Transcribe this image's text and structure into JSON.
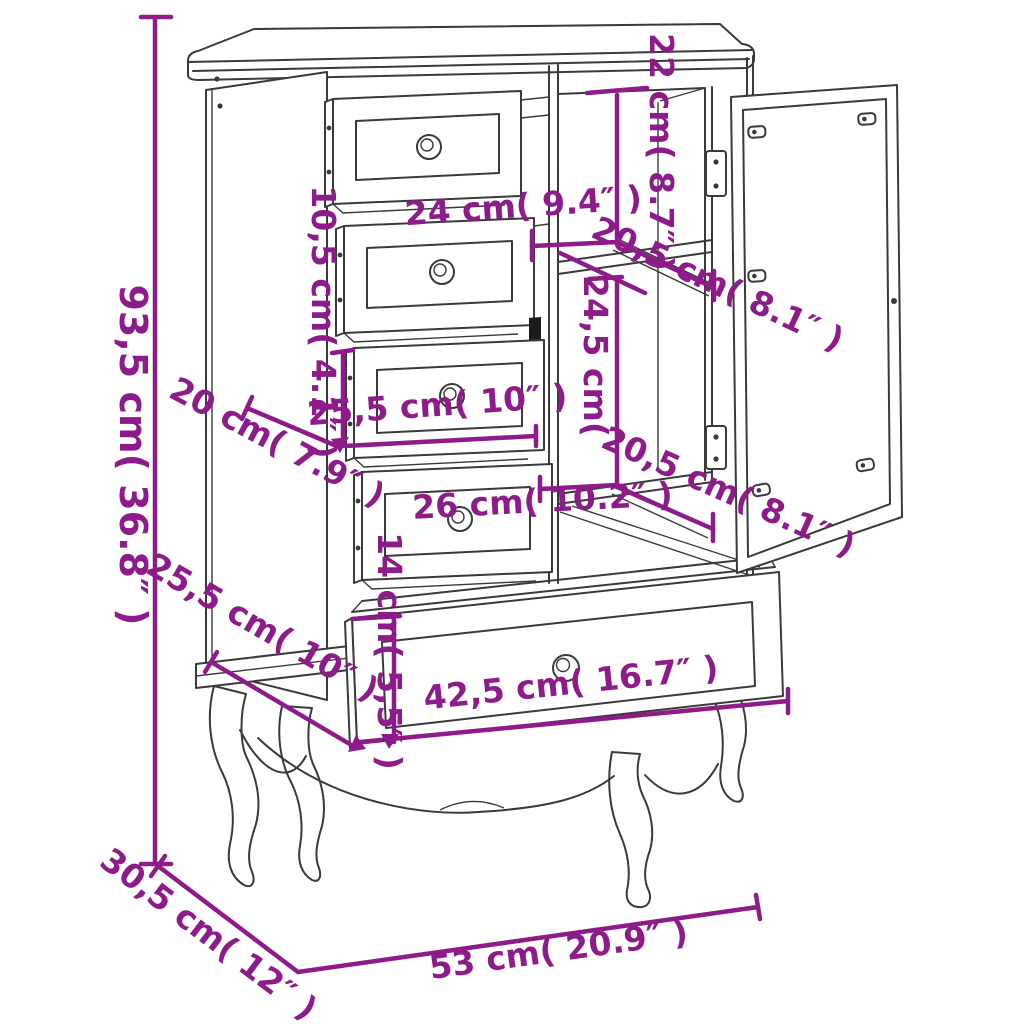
{
  "diagram": {
    "subject": "cabinet-with-drawers-and-glass-door",
    "background_color": "#ffffff",
    "line_color": "#3a3a3a",
    "dimension_color": "#8e1b8a",
    "dimensions": [
      {
        "id": "overall-height",
        "label": "93,5 cm( 36.8″ )"
      },
      {
        "id": "base-depth",
        "label": "30,5 cm( 12″ )"
      },
      {
        "id": "base-width",
        "label": "53 cm( 20.9″ )"
      },
      {
        "id": "upper-compartment-height",
        "label": "22 cm( 8.7″ )"
      },
      {
        "id": "compartment-width",
        "label": "24 cm( 9.4″ )"
      },
      {
        "id": "shelf-depth-upper",
        "label": "20,5 cm( 8.1″ )"
      },
      {
        "id": "lower-compartment-height",
        "label": "24,5 cm("
      },
      {
        "id": "drawer-front-height",
        "label": "10,5 cm( 4.1″ )"
      },
      {
        "id": "drawer-depth",
        "label": "20 cm( 7.9″ )"
      },
      {
        "id": "drawer-width",
        "label": "25,5 cm( 10″ )"
      },
      {
        "id": "drawer-opening-width",
        "label": "26 cm( 10.2″ )"
      },
      {
        "id": "shelf-depth-lower",
        "label": "20,5 cm( 8.1″ )"
      },
      {
        "id": "bottom-drawer-height",
        "label": "14 cm( 5,5″ )"
      },
      {
        "id": "bottom-drawer-depth",
        "label": "25,5 cm( 10″ )"
      },
      {
        "id": "bottom-drawer-width",
        "label": "42,5 cm( 16.7″ )"
      }
    ]
  }
}
